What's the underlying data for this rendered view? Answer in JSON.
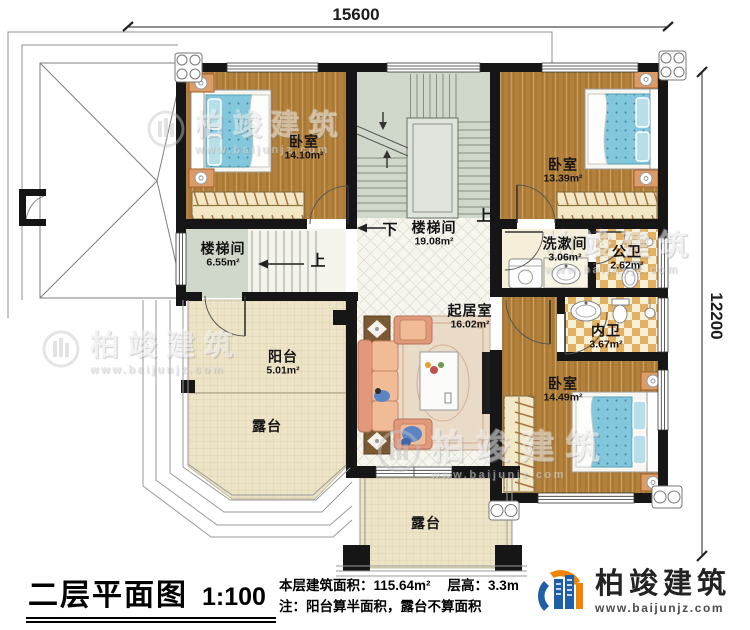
{
  "plan": {
    "title": "二层平面图",
    "scale": "1:100",
    "stats": {
      "area_label": "本层建筑面积：",
      "area_value": "115.64m²",
      "height_label": "层高：",
      "height_value": "3.3m",
      "note": "注：阳台算半面积，露台不算面积"
    },
    "dimensions": {
      "width": "15600",
      "height": "12200"
    },
    "stair_labels": {
      "up": "上",
      "down": "下"
    },
    "rooms": {
      "bedroom1": {
        "name": "卧室",
        "area": "14.10m²"
      },
      "bedroom2": {
        "name": "卧室",
        "area": "13.39m²"
      },
      "bedroom3": {
        "name": "卧室",
        "area": "14.49m²"
      },
      "stairwell_main": {
        "name": "楼梯间",
        "area": "19.08m²"
      },
      "stairwell_small": {
        "name": "楼梯间",
        "area": "6.55m²"
      },
      "washroom": {
        "name": "洗漱间",
        "area": "3.06m²"
      },
      "public_bath": {
        "name": "公卫",
        "area": "2.62m²"
      },
      "ensuite_bath": {
        "name": "内卫",
        "area": "3.67m²"
      },
      "living": {
        "name": "起居室",
        "area": "16.02m²"
      },
      "balcony": {
        "name": "阳台",
        "area": "5.01m²"
      },
      "terrace_left": {
        "name": "露台"
      },
      "terrace_bottom": {
        "name": "露台"
      }
    },
    "watermark": {
      "brand": "柏竣建筑",
      "url": "www.baijunjz.com"
    },
    "logo": {
      "brand": "柏竣建筑",
      "url": "www.baijunjz.com",
      "blue": "#1e5fa8",
      "orange": "#f08300"
    },
    "colors": {
      "wall": "#161616",
      "wood_floor": "#b3813c",
      "bed_blue": "#82c7dc",
      "tile": "#e3b164",
      "stair_floor": "#cfd8cb",
      "terrace_floor": "#ede4c7"
    }
  }
}
